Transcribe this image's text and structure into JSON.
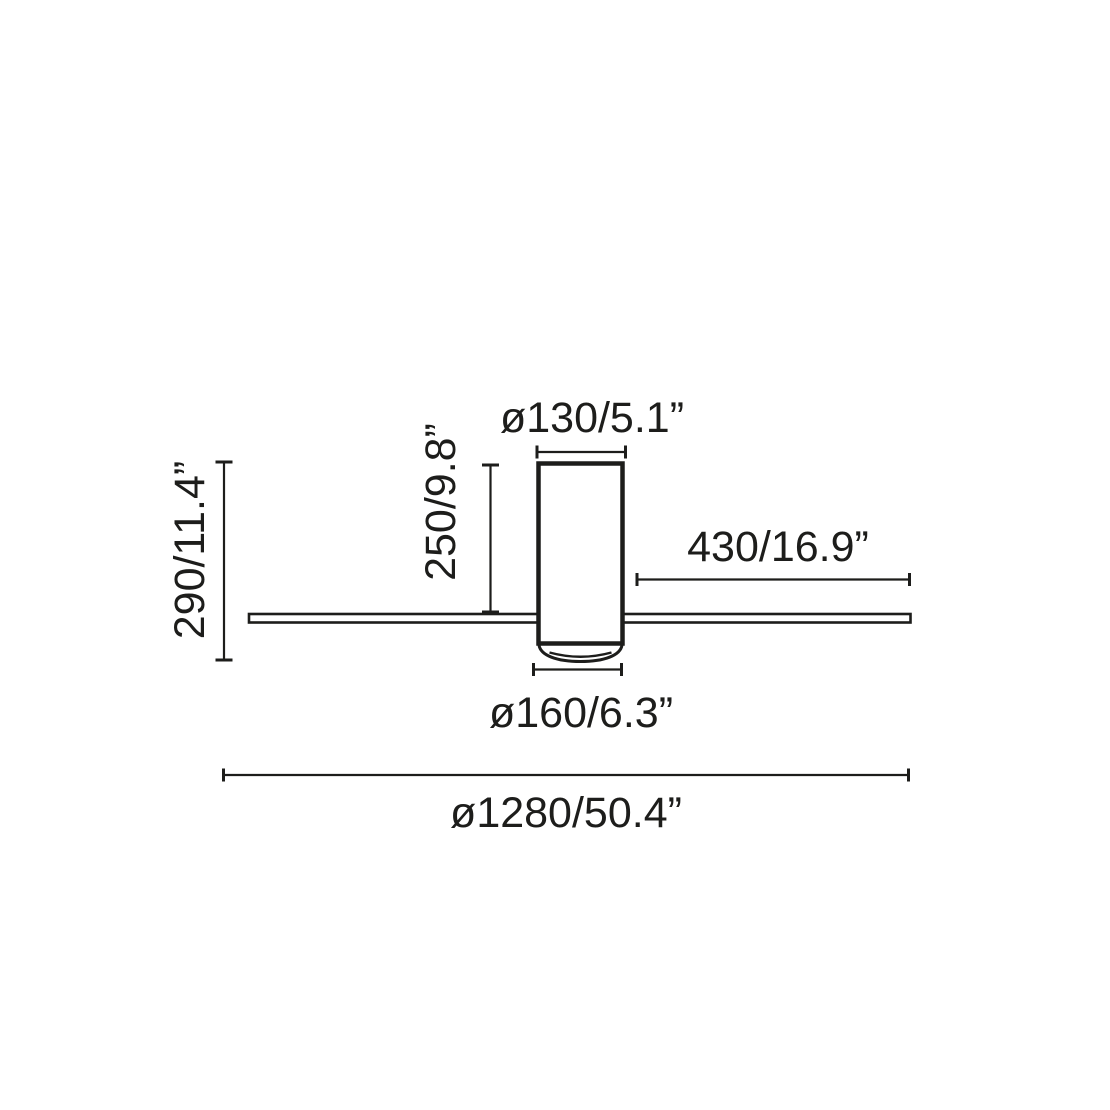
{
  "colors": {
    "line": "#1d1d1b",
    "background": "#ffffff"
  },
  "labels": {
    "top_diameter": "ø130/5.1”",
    "body_height": "250/9.8”",
    "total_height": "290/11.4”",
    "blade_length": "430/16.9”",
    "bottom_diameter": "ø160/6.3”",
    "total_diameter": "ø1280/50.4”"
  }
}
